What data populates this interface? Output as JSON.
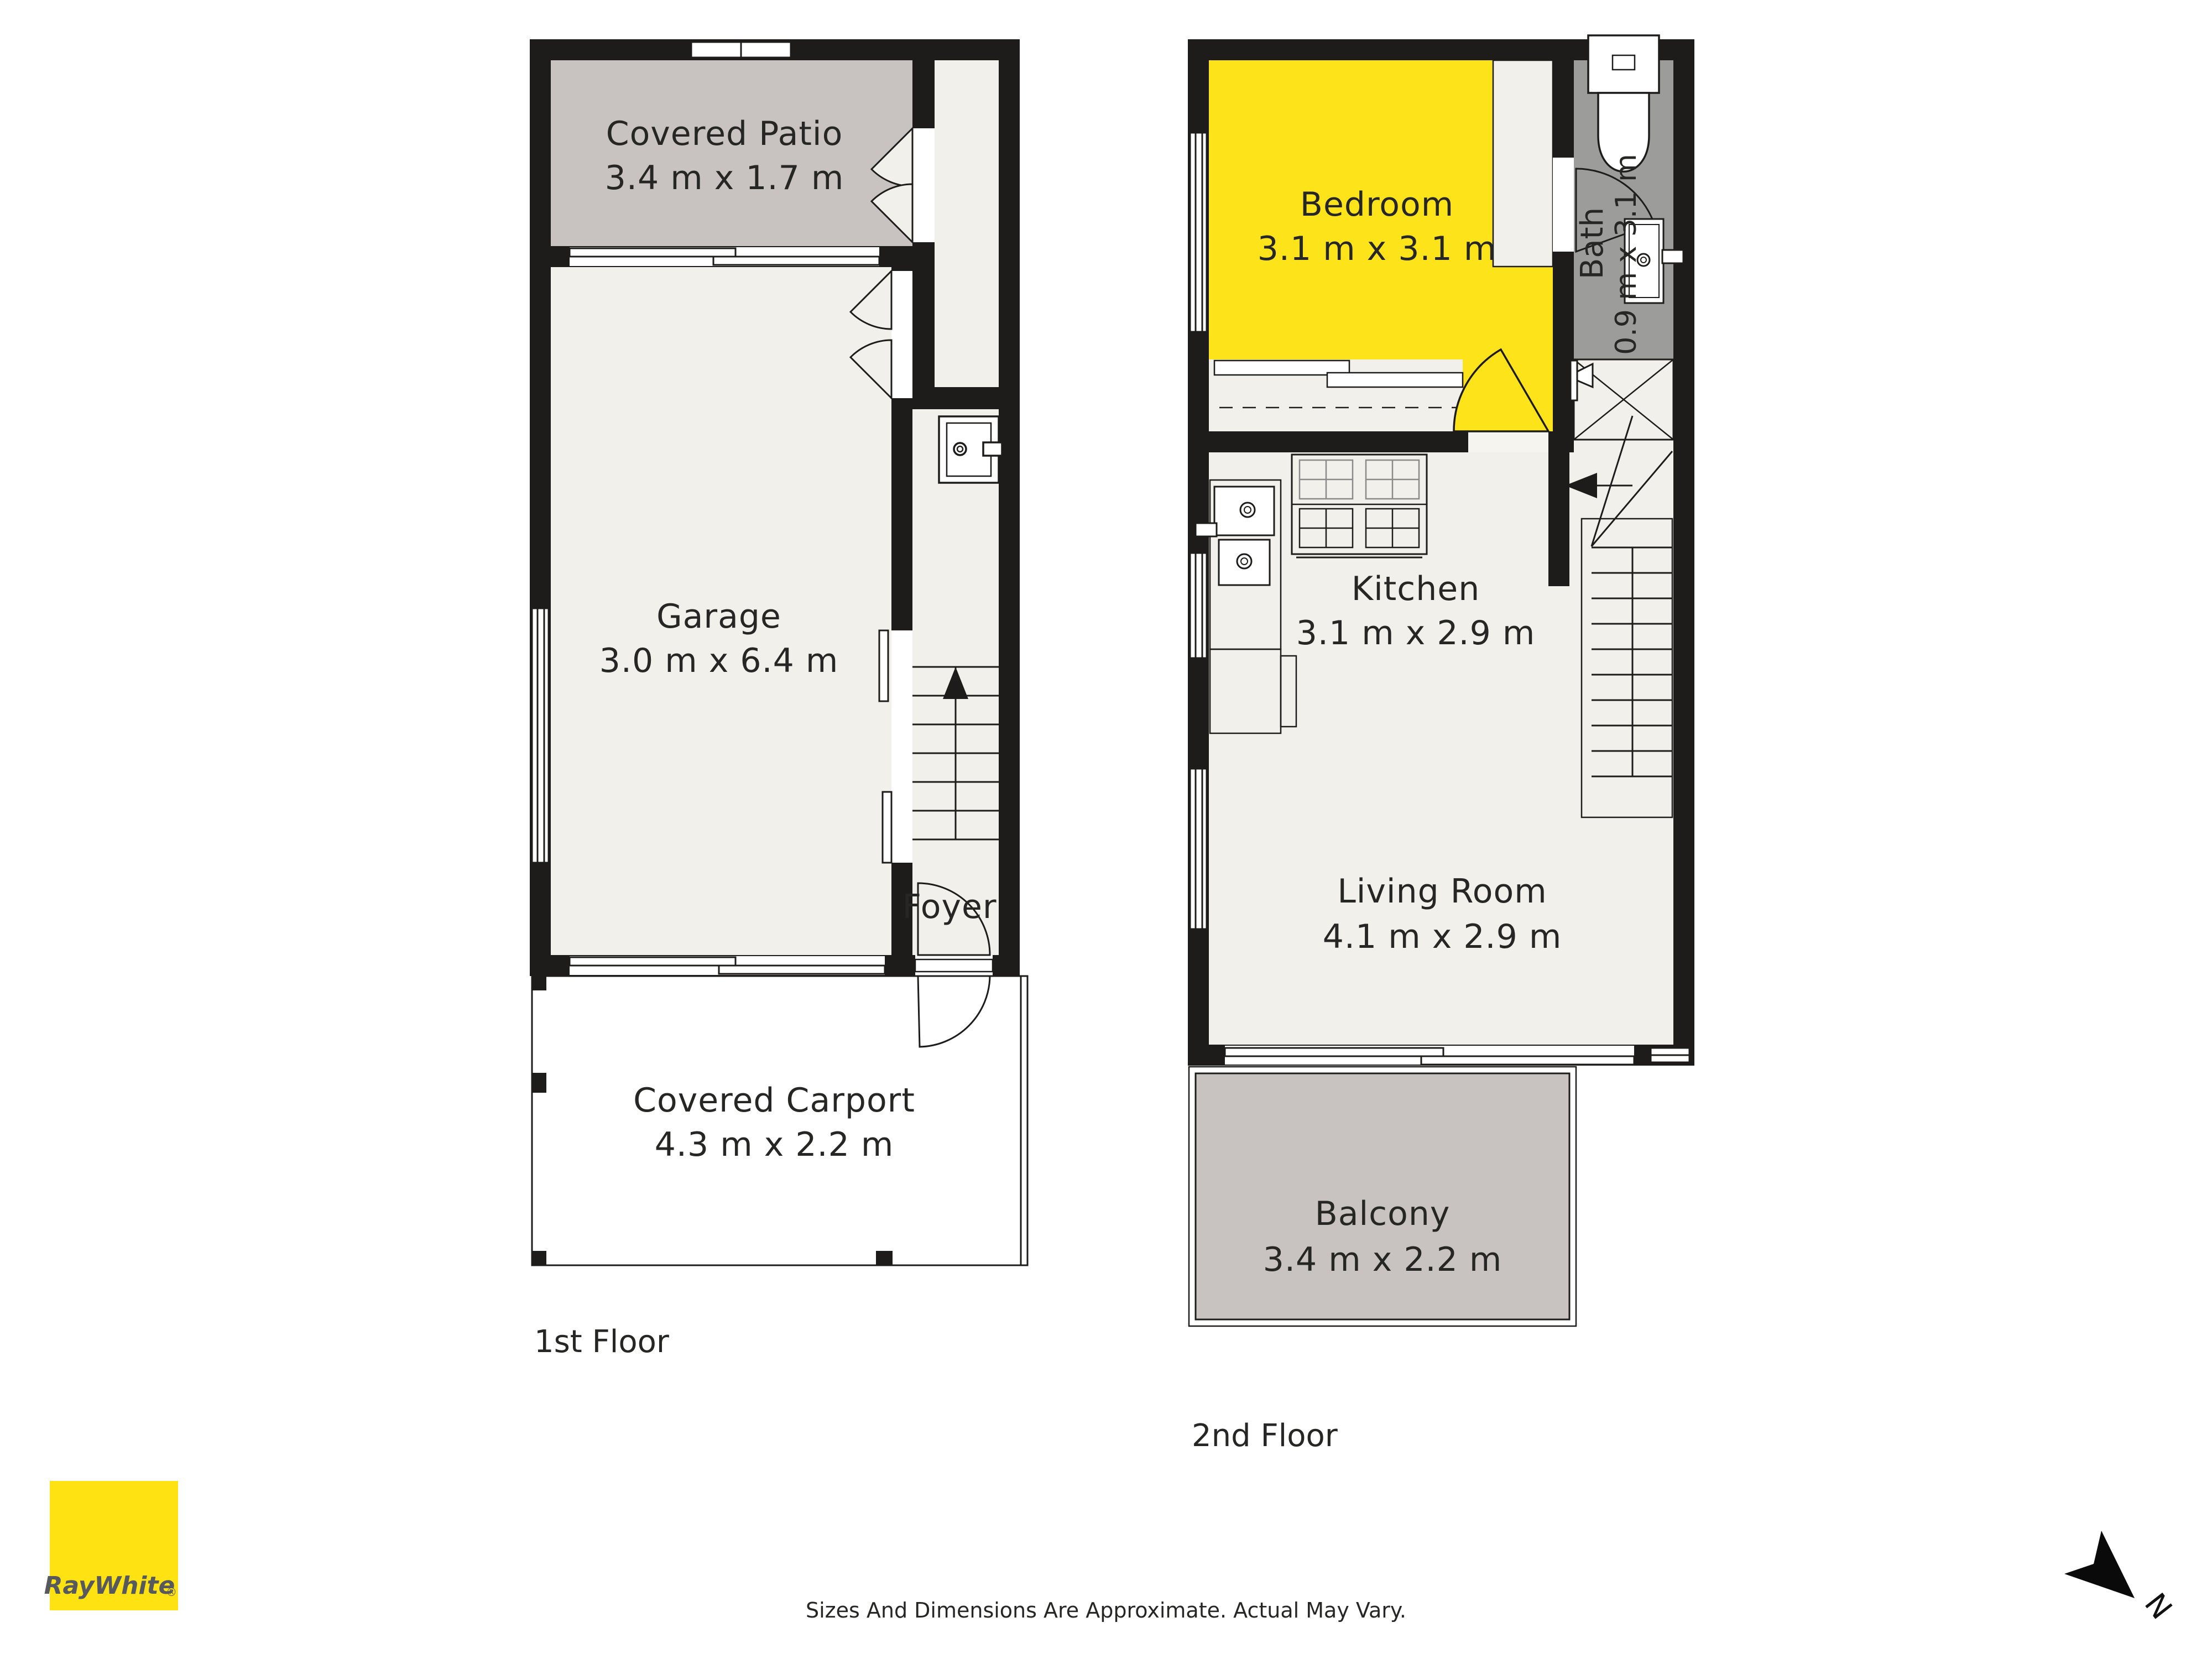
{
  "colors": {
    "wall": "#1d1c1a",
    "room_fill": "#f2f0eb",
    "outdoor_gray": "#c8c3c0",
    "bath_gray": "#9c9c9a",
    "highlight_yellow": "#fde31a",
    "logo_yellow": "#ffe212",
    "logo_text_color": "#56595d",
    "text": "#262624"
  },
  "floors": [
    {
      "name": "1st Floor",
      "rooms": [
        {
          "label": "Covered Patio",
          "dims": "3.4 m x 1.7 m"
        },
        {
          "label": "Garage",
          "dims": "3.0 m x 6.4 m"
        },
        {
          "label": "Foyer",
          "dims": ""
        },
        {
          "label": "Covered Carport",
          "dims": "4.3 m x 2.2 m"
        }
      ]
    },
    {
      "name": "2nd Floor",
      "rooms": [
        {
          "label": "Bedroom",
          "dims": "3.1 m x 3.1 m"
        },
        {
          "label": "Bath",
          "dims": "0.9 m x 3.1 m"
        },
        {
          "label": "Kitchen",
          "dims": "3.1 m x 2.9 m"
        },
        {
          "label": "Living Room",
          "dims": "4.1 m x 2.9 m"
        },
        {
          "label": "Balcony",
          "dims": "3.4 m x 2.2 m"
        }
      ]
    }
  ],
  "branding": {
    "logo_text": "RayWhite",
    "registered_mark": "®"
  },
  "compass": {
    "label": "N"
  },
  "footer": {
    "disclaimer": "Sizes And Dimensions Are Approximate. Actual May Vary."
  }
}
